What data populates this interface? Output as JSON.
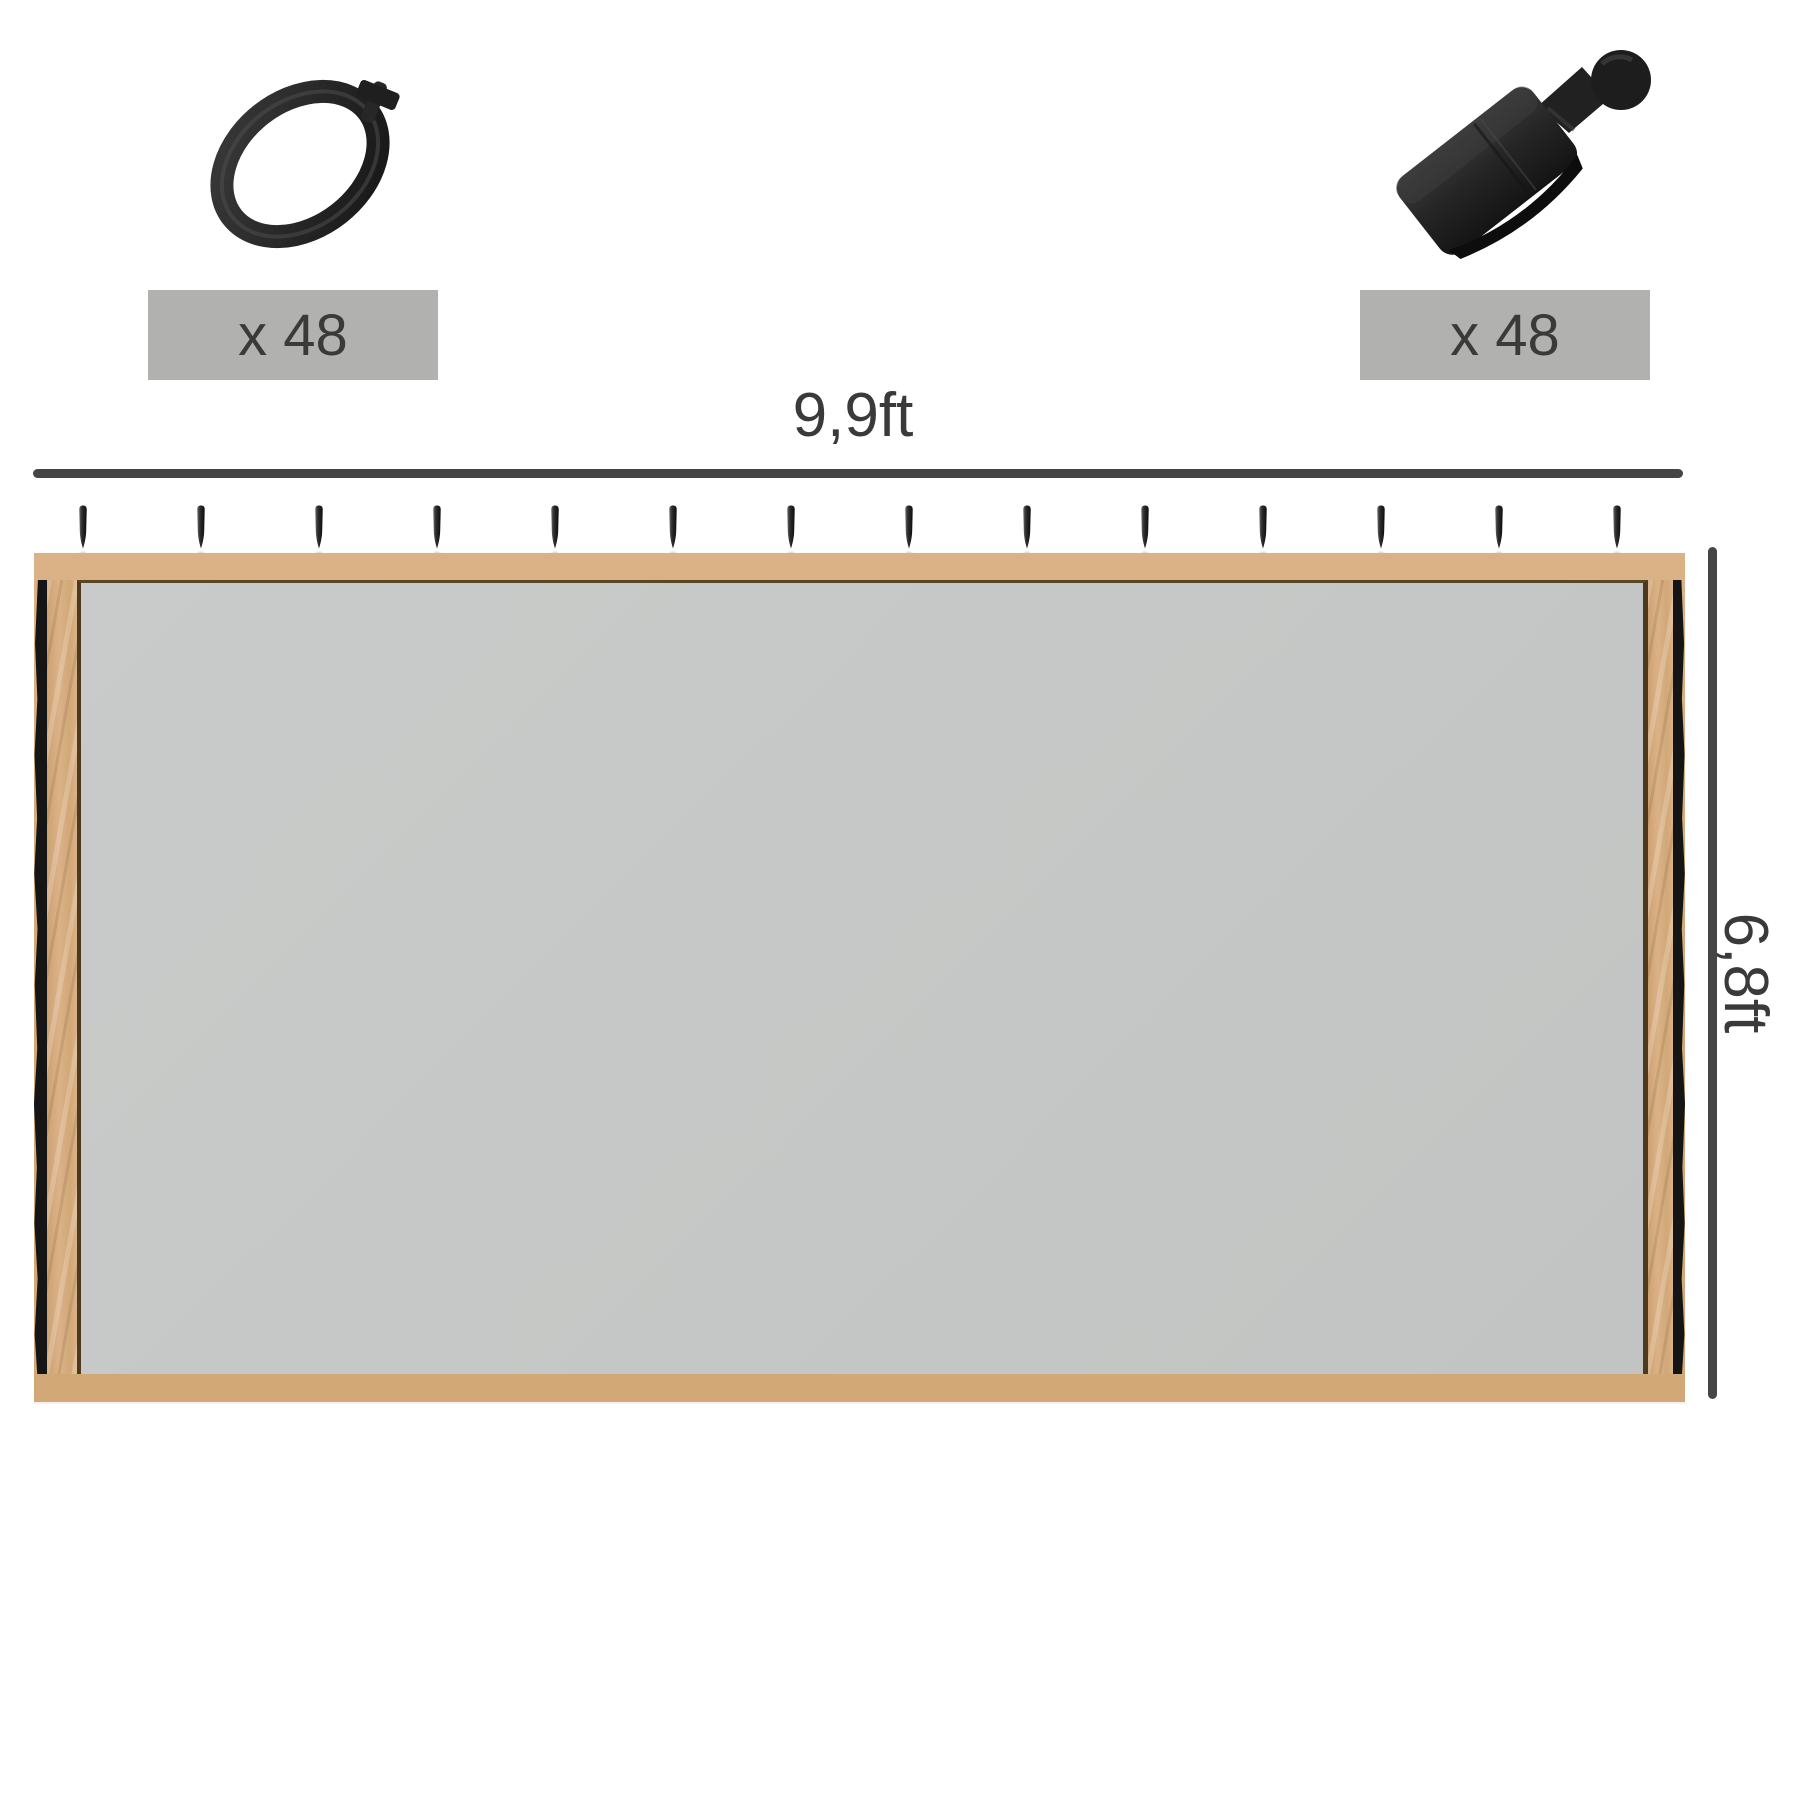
{
  "colors": {
    "background": "#ffffff",
    "text": "#3a3a3a",
    "dim_line": "#454545",
    "label_bg": "#b1b1af",
    "frame_tan": "#d1a876",
    "frame_tan_light": "#dbb287",
    "frame_edge_dark": "#4d3a1e",
    "fabric_gray": "#c6c8c7",
    "edge_black": "#151515",
    "part_black": "#242424"
  },
  "parts": {
    "ring": {
      "name": "curtain ring",
      "count_label": "x 48"
    },
    "clip": {
      "name": "ball head clip",
      "count_label": "x 48"
    }
  },
  "dimensions": {
    "width_label": "9,9ft",
    "height_label": "6,8ft"
  },
  "panel": {
    "hook_count": 14
  }
}
